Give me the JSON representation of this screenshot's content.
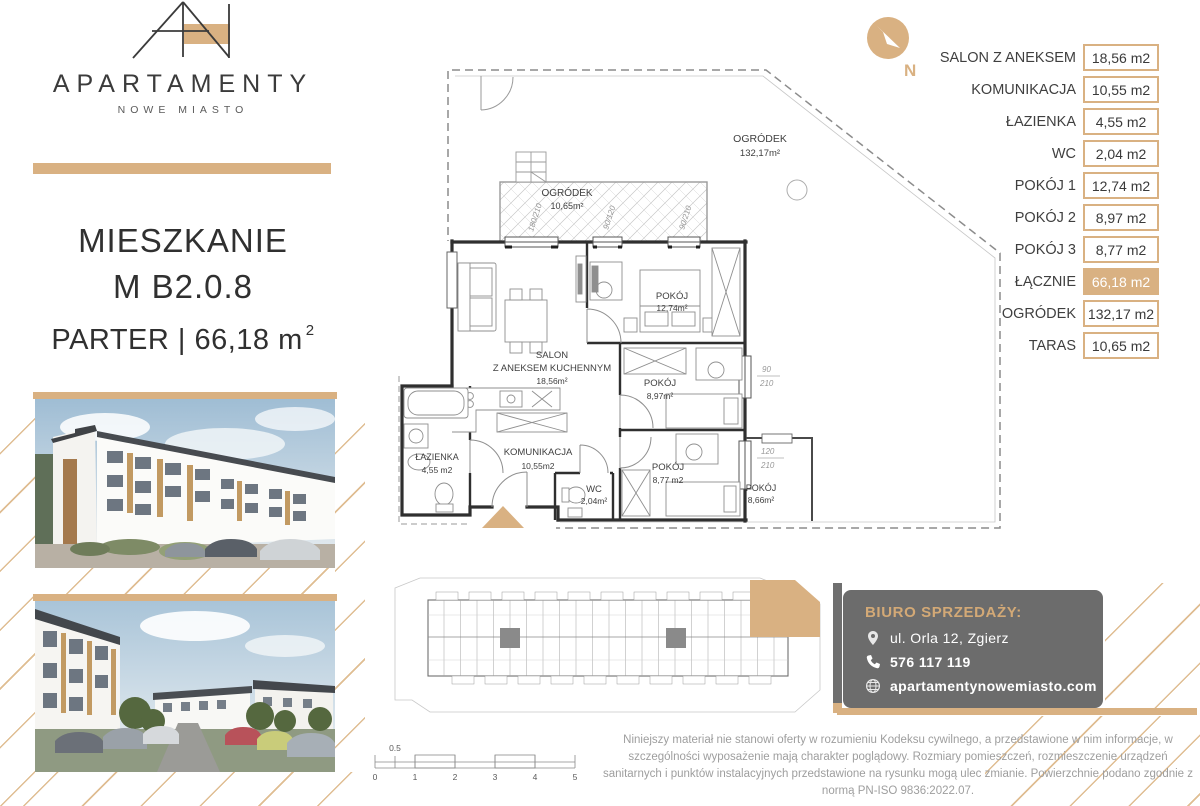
{
  "brand": {
    "name": "APARTAMENTY",
    "subtitle": "NOWE MIASTO"
  },
  "listing": {
    "type_label": "MIESZKANIE",
    "unit": "M B2.0.8",
    "floor_line": "PARTER | 66,18 m",
    "area_sup": "2"
  },
  "compass": {
    "label": "N"
  },
  "area_table": {
    "rows": [
      {
        "label": "SALON Z ANEKSEM",
        "value": "18,56 m2"
      },
      {
        "label": "KOMUNIKACJA",
        "value": "10,55 m2"
      },
      {
        "label": "ŁAZIENKA",
        "value": "4,55 m2"
      },
      {
        "label": "WC",
        "value": "2,04 m2"
      },
      {
        "label": "POKÓJ 1",
        "value": "12,74 m2"
      },
      {
        "label": "POKÓJ 2",
        "value": "8,97 m2"
      },
      {
        "label": "POKÓJ 3",
        "value": "8,77 m2"
      },
      {
        "label": "ŁĄCZNIE",
        "value": "66,18 m2"
      },
      {
        "label": "OGRÓDEK",
        "value": "132,17 m2"
      },
      {
        "label": "TARAS",
        "value": "10,65 m2"
      }
    ]
  },
  "plan": {
    "ogrodek": {
      "name": "OGRÓDEK",
      "area": "132,17m²"
    },
    "taras": {
      "name": "OGRÓDEK",
      "area": "10,65m²"
    },
    "salon": {
      "l1": "SALON",
      "l2": "Z ANEKSEM KUCHENNYM",
      "area": "18,56m²"
    },
    "pokoj1": {
      "name": "POKÓJ",
      "area": "12,74m²"
    },
    "pokoj2": {
      "name": "POKÓJ",
      "area": "8,97m²"
    },
    "pokoj3": {
      "name": "POKÓJ",
      "area": "8,77 m2"
    },
    "pokoj_neighbor": {
      "name": "POKÓJ",
      "area": "8,66m²"
    },
    "lazienka": {
      "name": "ŁAZIENKA",
      "area": "4,55 m2"
    },
    "komunikacja": {
      "name": "KOMUNIKACJA",
      "area": "10,55m2"
    },
    "wc": {
      "name": "WC",
      "area": "2,04m²"
    },
    "window_dims": [
      "180/210",
      "90/120",
      "90/210"
    ],
    "right_dims": [
      {
        "w": "90",
        "h": "210"
      },
      {
        "w": "120",
        "h": "210"
      }
    ]
  },
  "sales_office": {
    "title": "BIURO SPRZEDAŻY:",
    "address": "ul. Orla 12, Zgierz",
    "phone": "576 117 119",
    "website": "apartamentynowemiasto.com"
  },
  "scale_bar": {
    "labels": [
      "0",
      "1",
      "2",
      "3",
      "4",
      "5"
    ],
    "half_label": "0.5"
  },
  "disclaimer": "Niniejszy materiał nie stanowi oferty w rozumieniu Kodeksu cywilnego, a przedstawione w nim informacje, w szczególności wyposażenie mają charakter poglądowy. Rozmiary pomieszczeń, rozmieszczenie urządzeń sanitarnych i punktów instalacyjnych przedstawione na rysunku mogą ulec zmianie. Powierzchnie podano zgodnie z normą PN-ISO 9836:2022.07.",
  "colors": {
    "accent": "#d9b182",
    "box_gray": "#6c6c6c",
    "dark": "#3a3a3a"
  }
}
